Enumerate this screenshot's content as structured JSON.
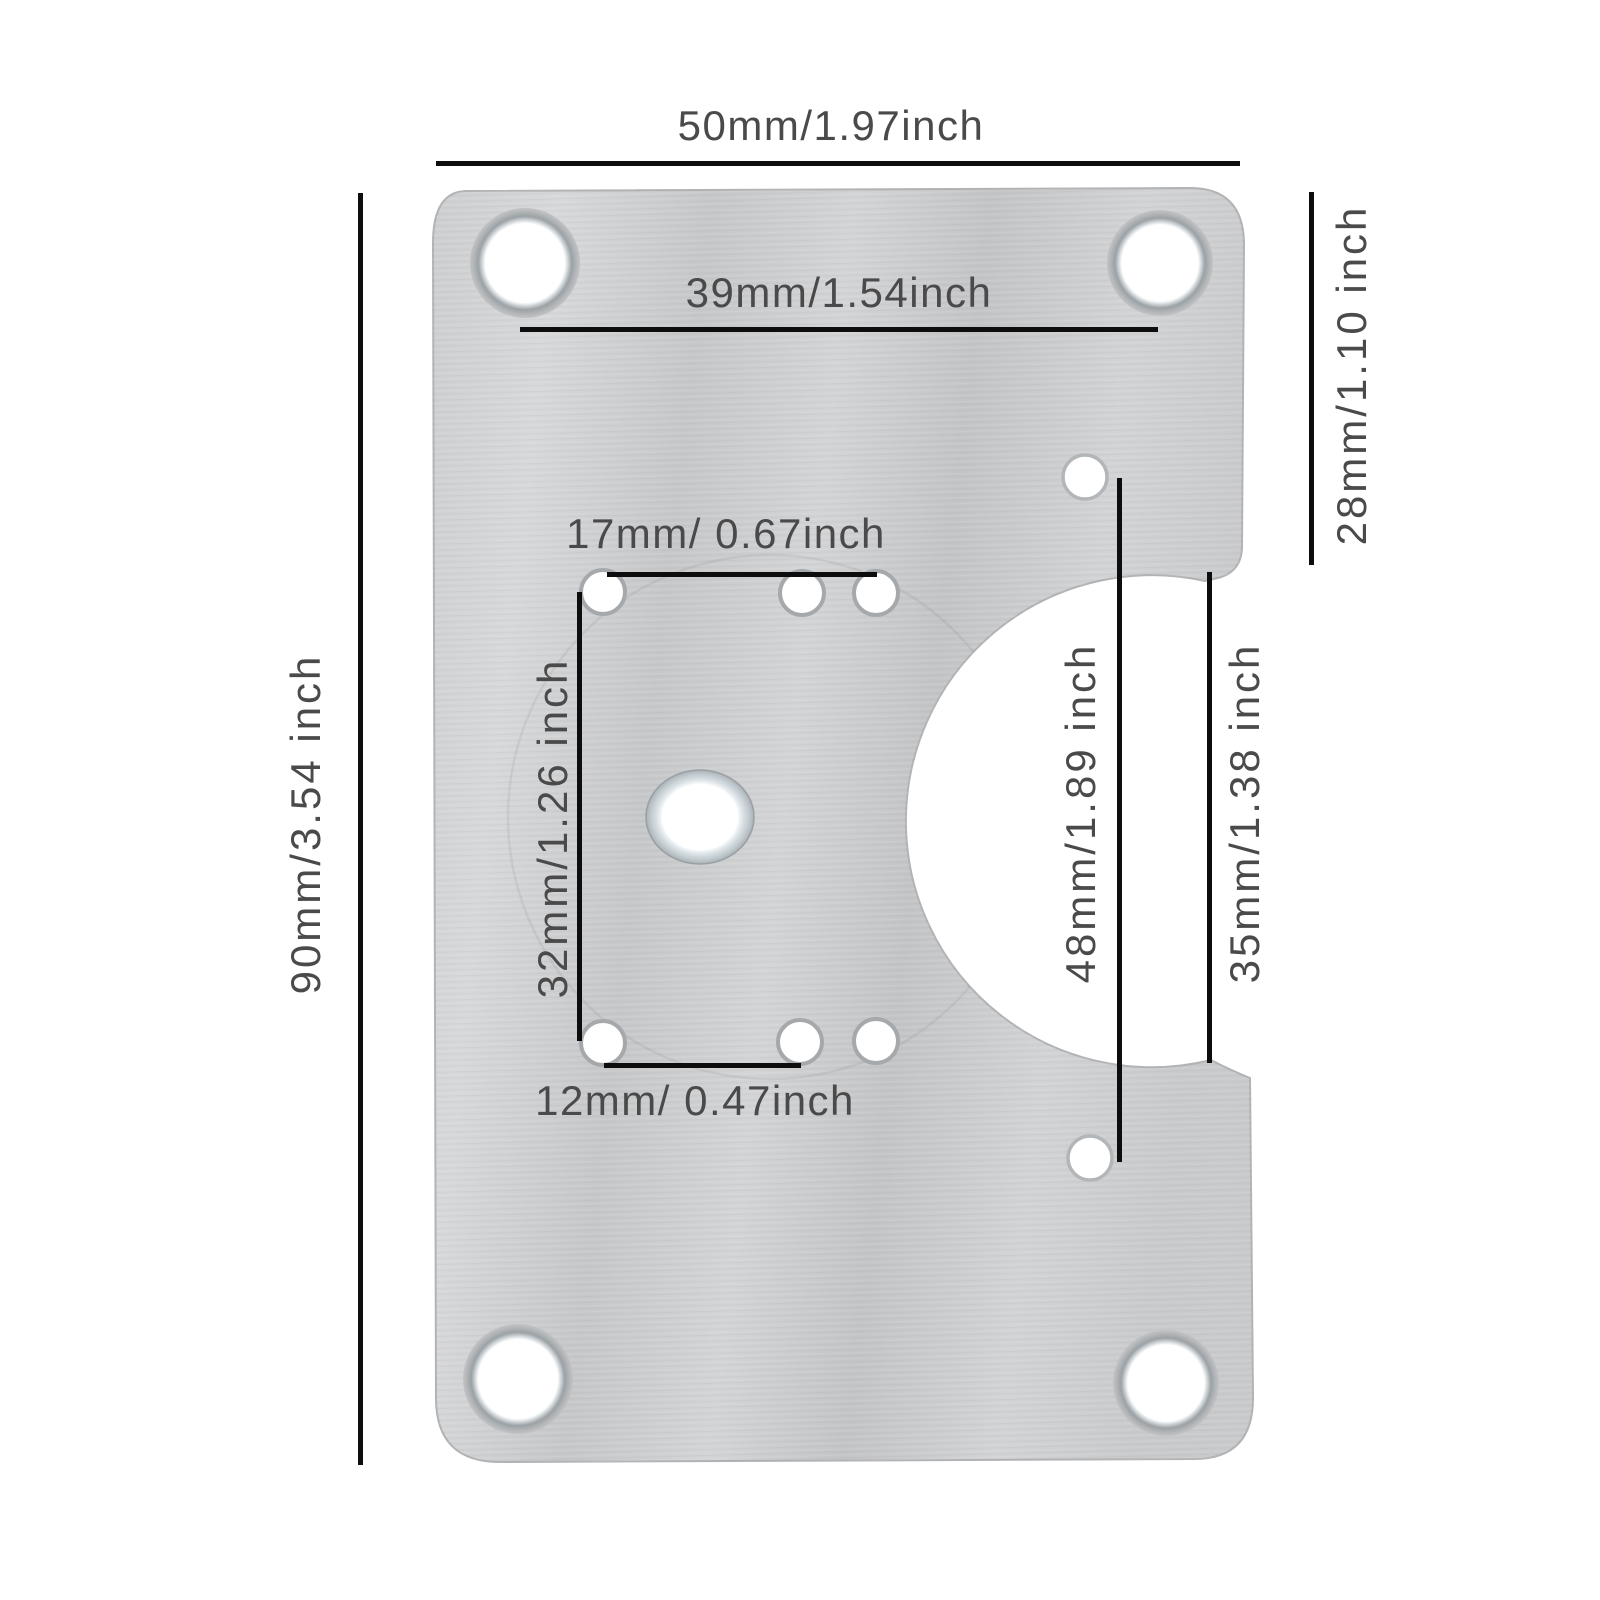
{
  "diagram": {
    "background": "#ffffff",
    "subject": "Stainless steel cabinet hinge repair plate dimension diagram",
    "line_color": "#0d0d0d",
    "text_color": "#4a4a4a",
    "plate_colors": {
      "base": "#cbccce",
      "light": "#d9dadc",
      "dark": "#c1c2c4",
      "hole_rim": "#9ba1a5"
    }
  },
  "dimension_labels": {
    "top_width": "50mm/1.97inch",
    "top_hole_span": "39mm/1.54inch",
    "left_height": "90mm/3.54 inch",
    "right_tab_height": "28mm/1.10 inch",
    "small_top_span": "17mm/ 0.67inch",
    "vertical_span": "32mm/1.26 inch",
    "small_bottom_span": "12mm/ 0.47inch",
    "side_hole_span": "48mm/1.89 inch",
    "cutout_height": "35mm/1.38 inch"
  }
}
